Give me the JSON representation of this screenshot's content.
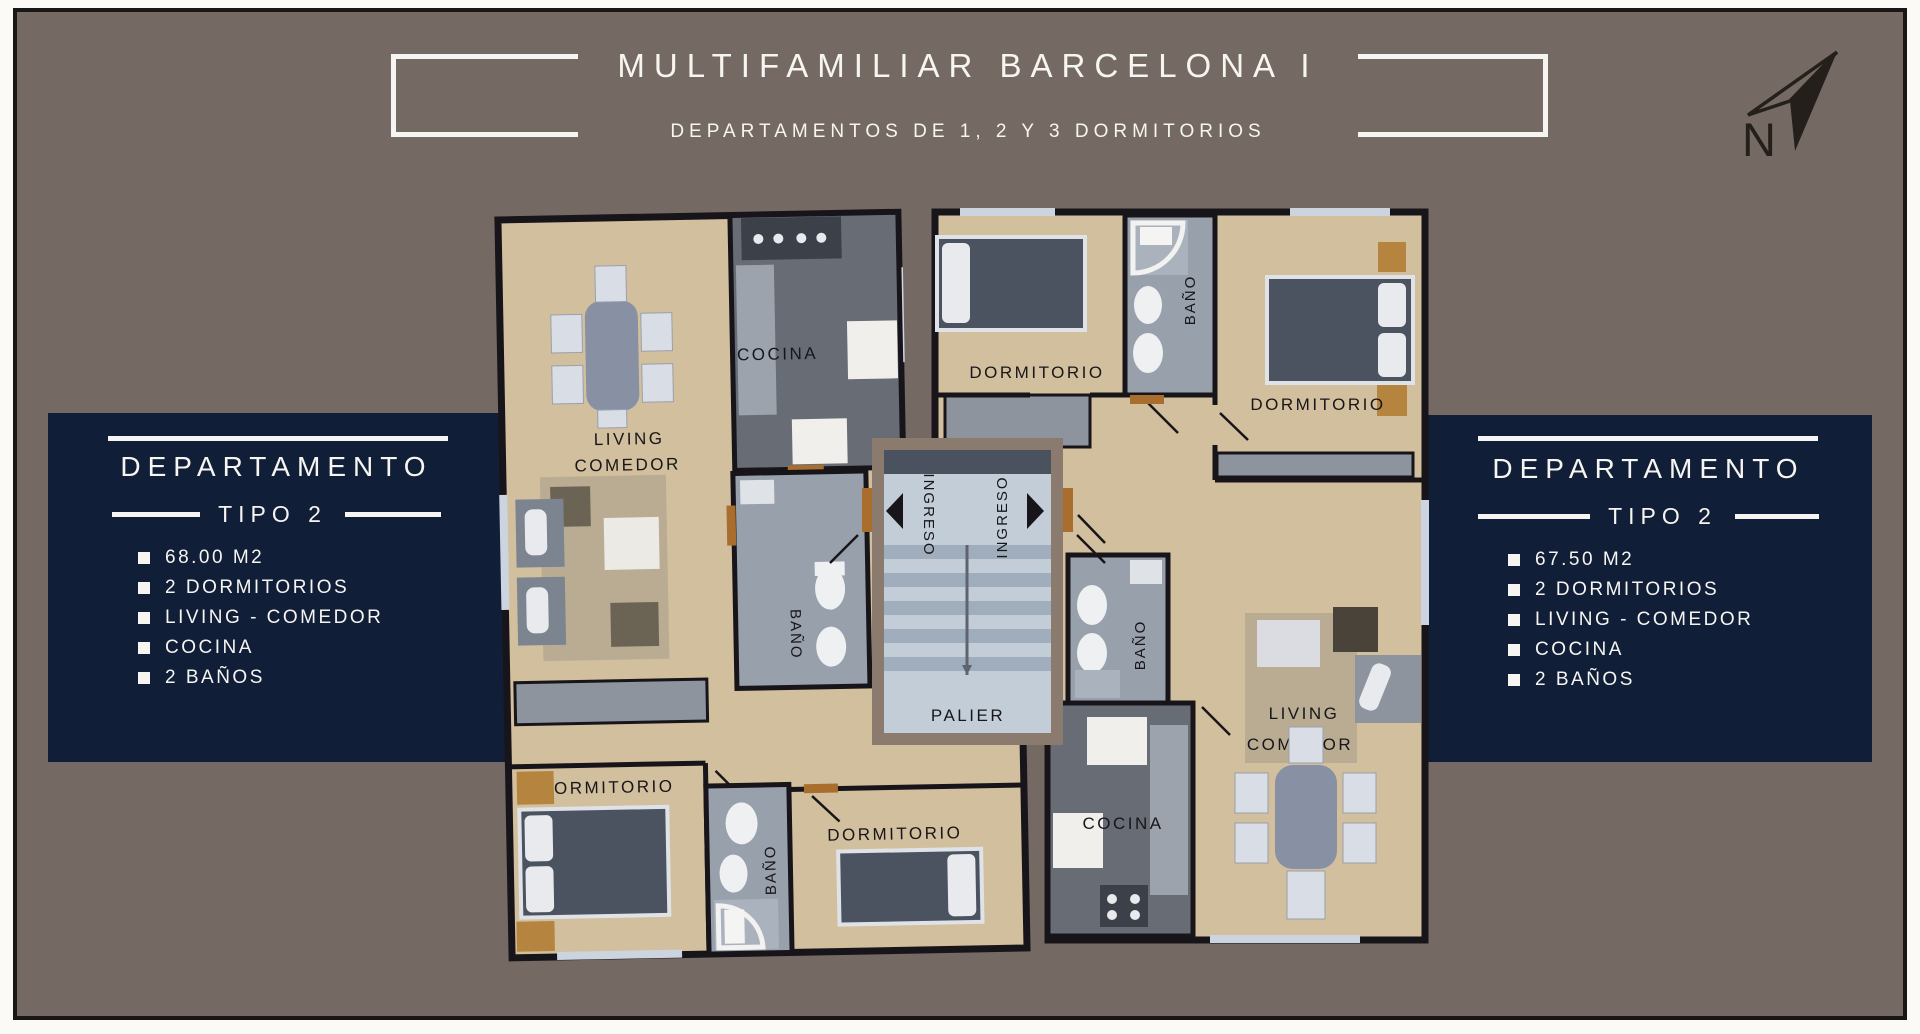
{
  "page": {
    "background": "#746a63",
    "panel_color": "#101e38",
    "accent_text": "#f7f5f1"
  },
  "header": {
    "title": "MULTIFAMILIAR BARCELONA I",
    "subtitle": "DEPARTAMENTOS DE 1, 2 Y 3 DORMITORIOS",
    "north_label": "N"
  },
  "left_panel": {
    "title_line1": "DEPARTAMENTO",
    "title_line2": "TIPO 2",
    "items": [
      "68.00 M2",
      "2 DORMITORIOS",
      "LIVING - COMEDOR",
      "COCINA",
      "2 BAÑOS"
    ]
  },
  "right_panel": {
    "title_line1": "DEPARTAMENTO",
    "title_line2": "TIPO 2",
    "items": [
      "67.50 M2",
      "2 DORMITORIOS",
      "LIVING - COMEDOR",
      "COCINA",
      "2 BAÑOS"
    ]
  },
  "floorplan": {
    "left_unit": {
      "living": "LIVING",
      "comedor": "COMEDOR",
      "cocina": "COCINA",
      "bano_center": "BAÑO",
      "bano_bottom": "BAÑO",
      "dormitorio_left": "DORMITORIO",
      "dormitorio_center": "DORMITORIO"
    },
    "right_unit": {
      "living": "LIVING",
      "comedor": "COMEDOR",
      "cocina": "COCINA",
      "bano_top": "BAÑO",
      "bano_center": "BAÑO",
      "dormitorio_left": "DORMITORIO",
      "dormitorio_right": "DORMITORIO"
    },
    "core": {
      "ingreso_left": "INGRESO",
      "ingreso_right": "INGRESO",
      "palier": "PALIER"
    }
  }
}
